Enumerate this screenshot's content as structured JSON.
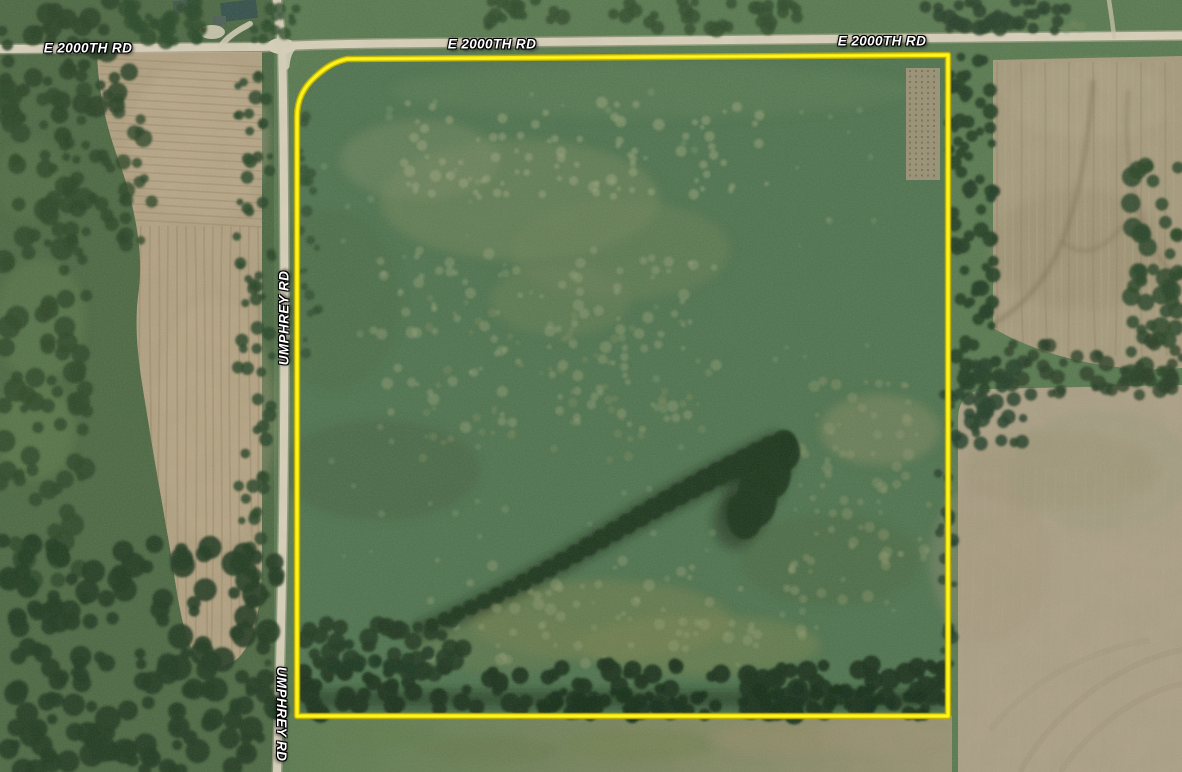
{
  "map": {
    "imagery": "satellite",
    "road_labels": [
      {
        "text": "E 2000TH RD",
        "road": "E 2000th Rd",
        "position": "west"
      },
      {
        "text": "E 2000TH RD",
        "road": "E 2000th Rd",
        "position": "center"
      },
      {
        "text": "E 2000TH RD",
        "road": "E 2000th Rd",
        "position": "east"
      },
      {
        "text": "UMPHREY RD",
        "road": "Umphrey Rd",
        "position": "north"
      },
      {
        "text": "UMPHREY RD",
        "road": "Umphrey Rd",
        "position": "south"
      }
    ],
    "parcel_boundary": {
      "color": "#f2e400",
      "label_text_color": "#ffffff"
    }
  }
}
